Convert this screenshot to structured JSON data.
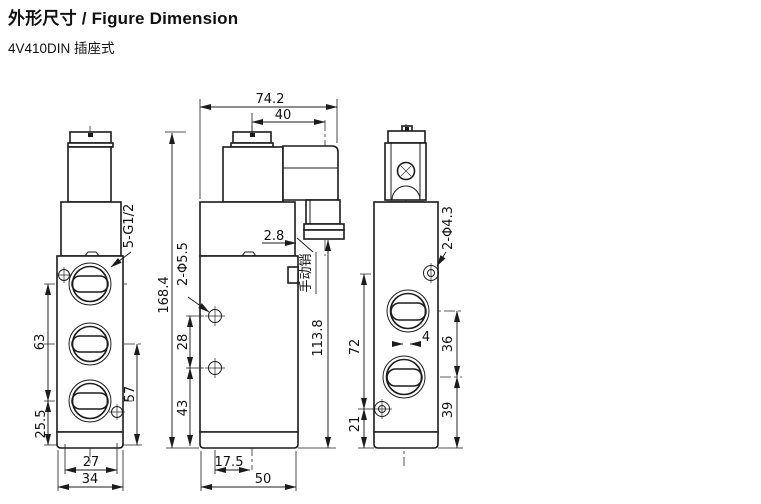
{
  "header": {
    "title": "外形尺寸 / Figure Dimension",
    "subtitle": "4V410DIN 插座式"
  },
  "front_view": {
    "port_thread": "5-G1/2",
    "port_spacing": "63",
    "bottom_offset": "25.5",
    "right_span": "57",
    "hole_span": "27",
    "body_width": "34"
  },
  "side_view": {
    "overall_width": "74.2",
    "connector_offset": "40",
    "overall_height": "168.4",
    "mount_holes": "2-Φ5.5",
    "hole_spacing": "28",
    "hole_bottom": "43",
    "body_height": "113.8",
    "pin_step": "2.8",
    "pin_label": "手动销",
    "hole_offset": "17.5",
    "body_depth": "50"
  },
  "rear_view": {
    "mount_holes": "2-Φ4.3",
    "hole_span": "72",
    "hole_bottom": "21",
    "port_offset": "4",
    "port_spacing": "36",
    "port_bottom": "39"
  }
}
